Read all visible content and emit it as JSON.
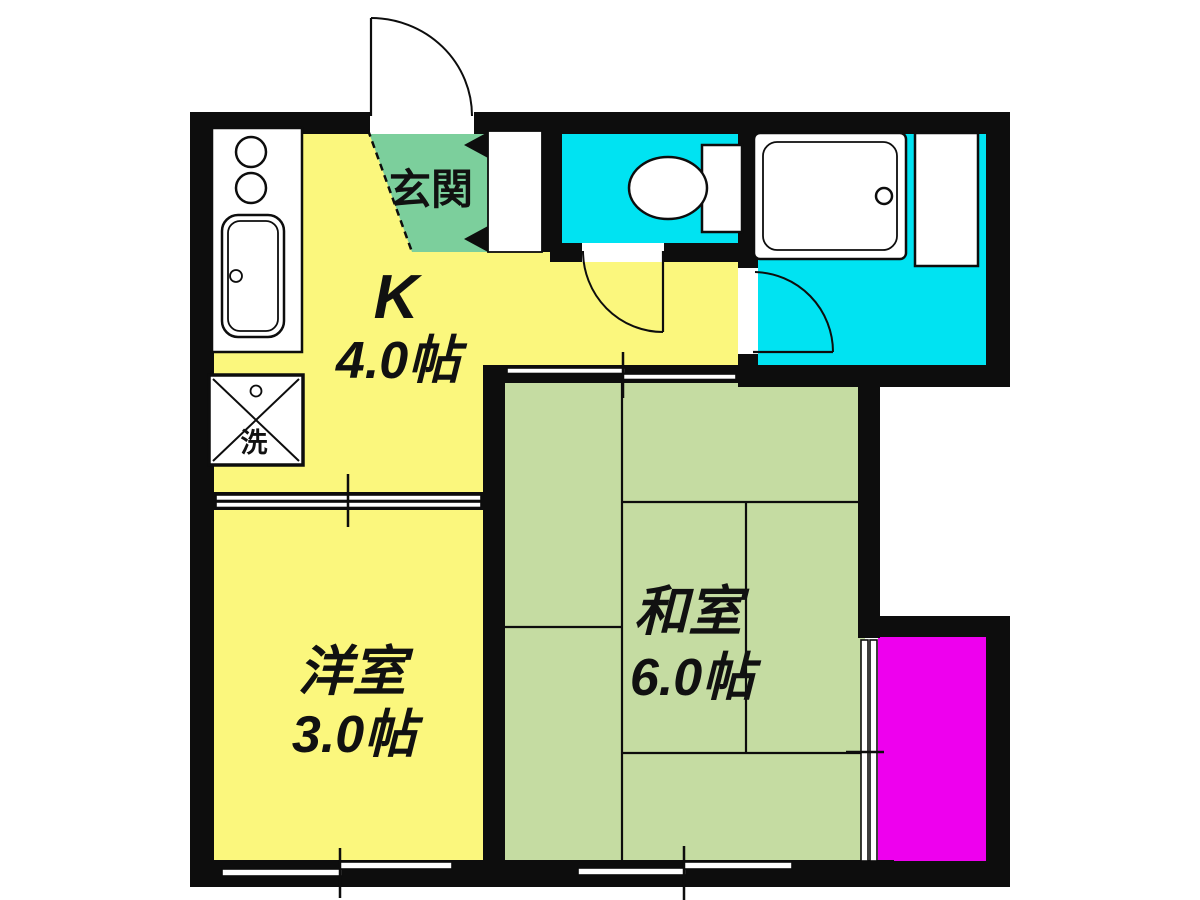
{
  "floorplan": {
    "type": "japanese-apartment-floor-plan",
    "labels": {
      "entrance": "玄関",
      "kitchen_name": "K",
      "kitchen_size": "4.0帖",
      "western_room_name": "洋室",
      "western_room_size": "3.0帖",
      "japanese_room_name": "和室",
      "japanese_room_size": "6.0帖",
      "laundry": "洗"
    },
    "colors": {
      "kitchen_yellow": "#FBF77D",
      "tatami_green": "#C5DCA2",
      "genkan_green": "#7CCF9C",
      "wet_area_cyan": "#00E3F2",
      "balcony_magenta": "#EE00EE",
      "wall_black": "#0D0D0D"
    }
  }
}
